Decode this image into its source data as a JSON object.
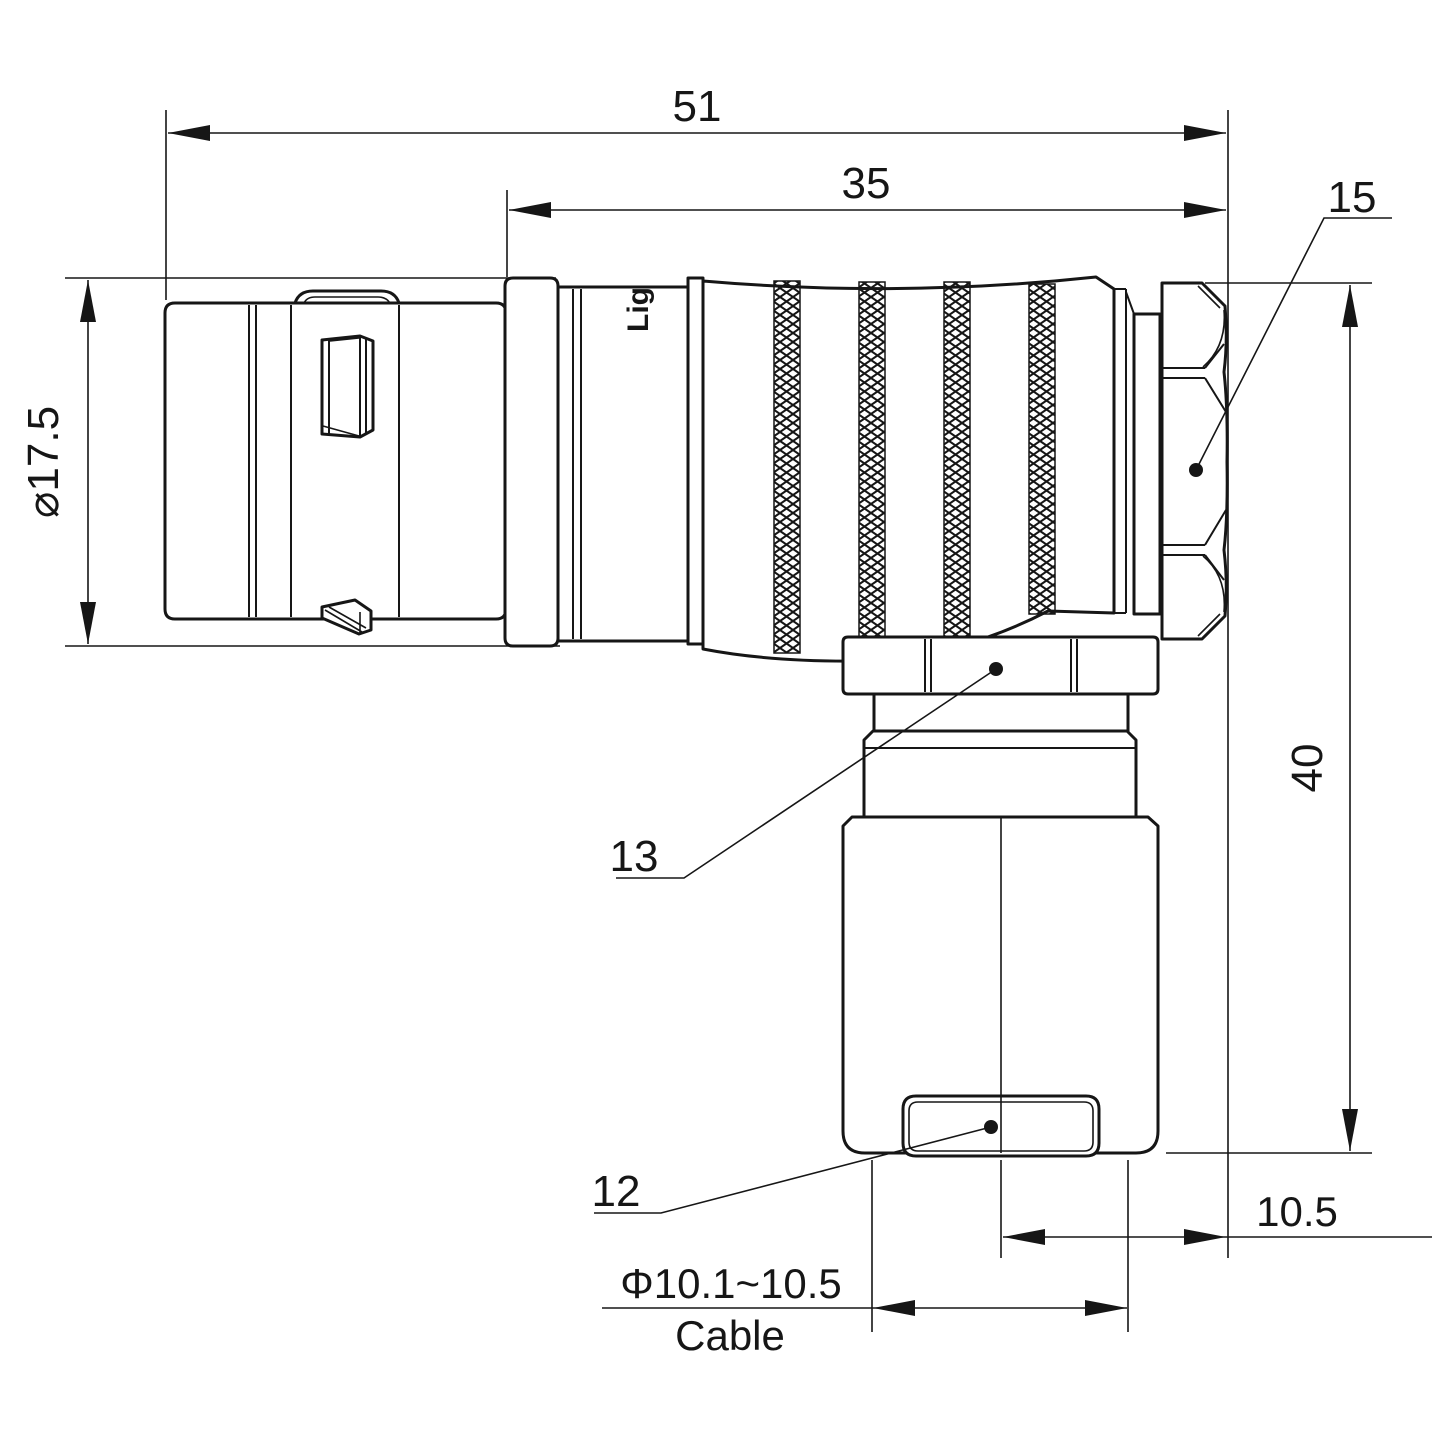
{
  "watermark": "Lightany",
  "engraving": "Lig",
  "dims": {
    "overall_length": "51",
    "body_length": "35",
    "front_diameter": "⌀17.5",
    "height": "40",
    "back_offset": "10.5",
    "cable_range": "Φ10.1~10.5",
    "cable_label": "Cable"
  },
  "labels": {
    "backnut": "15",
    "coupling_nut": "13",
    "cable_clamp": "12"
  }
}
